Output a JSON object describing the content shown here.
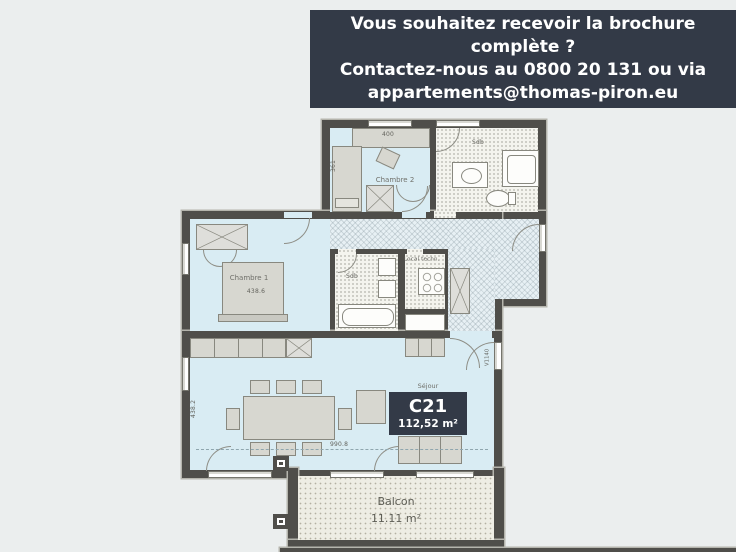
{
  "colors": {
    "background": "#ebeeee",
    "banner_bg": "#333a47",
    "banner_text": "#ffffff",
    "wall": "#4f4e4a",
    "room_floor": "#d9ecf3",
    "badge_bg": "#333a47"
  },
  "banner": {
    "line1": "Vous souhaitez recevoir la brochure complète ?",
    "line2": "Contactez-nous au 0800 20 131 ou via",
    "line3": "appartements@thomas-piron.eu"
  },
  "plan": {
    "rooms": {
      "chambre2": "Chambre 2",
      "chambre1": "Chambre 1",
      "sdb_top": "Sdb",
      "sdb_mid": "Sdb",
      "local_tech": "Local techn.",
      "sejour": "Séjour",
      "balcon": "Balcon"
    },
    "balcon_area": "11.11 m²",
    "badge": {
      "unit": "C21",
      "area": "112,52 m²"
    },
    "dimensions": {
      "desk_width": "400",
      "chambre2_height": "361",
      "chambre1_width": "438.6",
      "sejour_height": "438.2",
      "sejour_width": "990.8",
      "door_right": "V1140"
    }
  }
}
